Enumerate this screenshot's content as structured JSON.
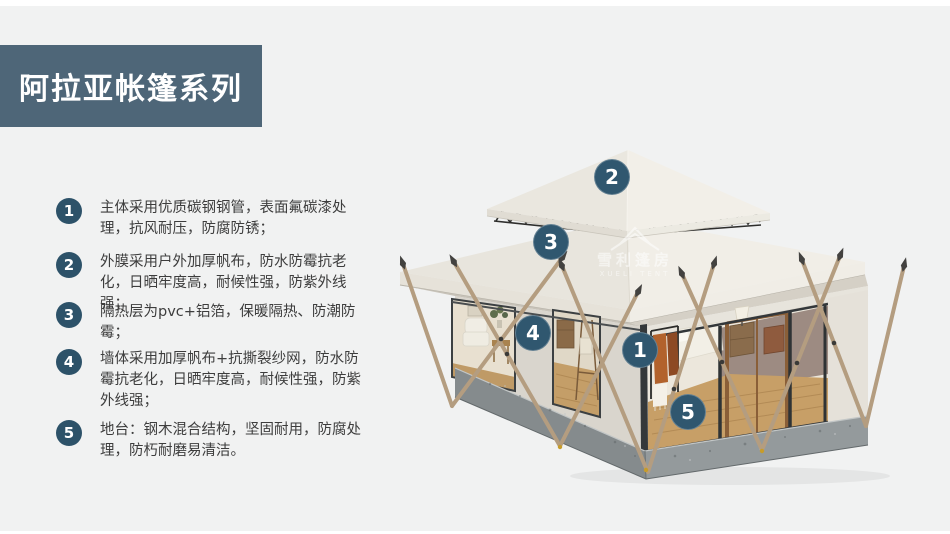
{
  "page": {
    "colors": {
      "bg": "#f1f2f2",
      "strip": "#ffffff",
      "accent": "#4e6678",
      "badge": "#2d5269",
      "marker": "#30576f",
      "text": "#3d3d3d",
      "canvas-light": "#f1eee7",
      "canvas-mid": "#e7e4dc",
      "canvas-dark": "#d9d5cd",
      "base-gray": "#8b9193",
      "pole-wood": "#b49d80",
      "floor-wood": "#c79f67"
    }
  },
  "header": {
    "title": "阿拉亚帐篷系列"
  },
  "features": {
    "items": [
      {
        "num": "1",
        "text": "主体采用优质碳钢钢管，表面氟碳漆处理，抗风耐压，防腐防锈；"
      },
      {
        "num": "2",
        "text": "外膜采用户外加厚帆布，防水防霉抗老化，日晒牢度高，耐候性强，防紫外线强；"
      },
      {
        "num": "3",
        "text": "隔热层为pvc+铝箔，保暖隔热、防潮防霉；"
      },
      {
        "num": "4",
        "text": "墙体采用加厚帆布+抗撕裂纱网，防水防霉抗老化，日晒牢度高，耐候性强，防紫外线强；"
      },
      {
        "num": "5",
        "text": "地台：钢木混合结构，坚固耐用，防腐处理，防朽耐磨易清洁。"
      }
    ]
  },
  "illustration": {
    "markers": [
      {
        "num": "1"
      },
      {
        "num": "2"
      },
      {
        "num": "3"
      },
      {
        "num": "4"
      },
      {
        "num": "5"
      }
    ],
    "watermark": {
      "cn": "雪利篷房",
      "en": "XUELI TENT"
    }
  }
}
